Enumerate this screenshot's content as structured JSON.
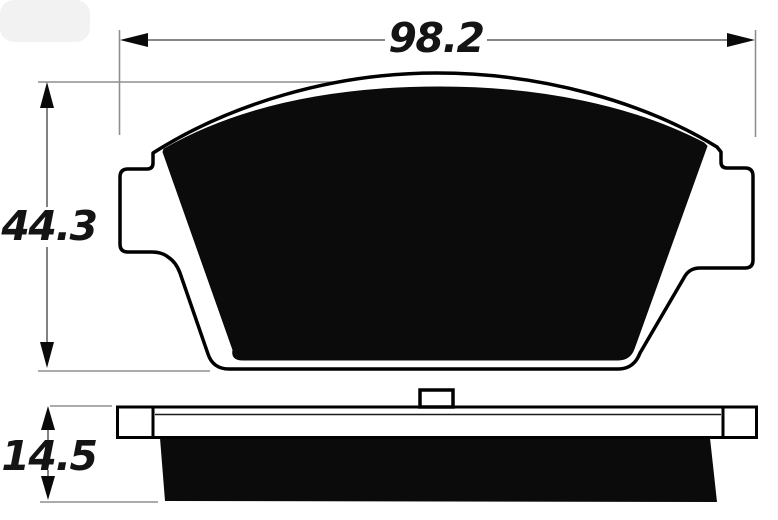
{
  "page": {
    "background_color": "#ffffff",
    "description": "Technical dimension drawing of a disc brake pad: front profile (top) and edge profile (bottom)"
  },
  "drawing": {
    "outline_color": "#000000",
    "plate_fill": "#ffffff",
    "friction_fill": "#0b0b0b",
    "dimension_line_color": "#757575",
    "extension_line_color": "#8f8f8f",
    "arrow_color": "#0a0a0a",
    "label_color": "#141414"
  },
  "dimensions": {
    "width": {
      "label": "98.2"
    },
    "height": {
      "label": "44.3"
    },
    "thickness": {
      "label": "14.5"
    }
  }
}
